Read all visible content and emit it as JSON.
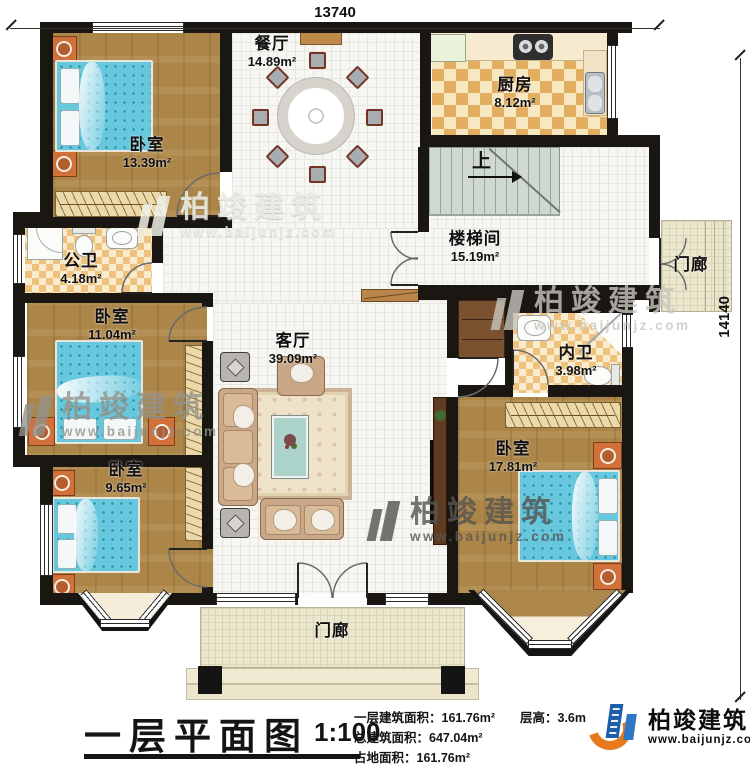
{
  "dimensions": {
    "top": "13740",
    "right": "14140"
  },
  "rooms": {
    "bedroom_tl": {
      "name": "卧室",
      "area": "13.39m²"
    },
    "dining": {
      "name": "餐厅",
      "area": "14.89m²"
    },
    "kitchen": {
      "name": "厨房",
      "area": "8.12m²"
    },
    "stairwell": {
      "name": "楼梯间",
      "area": "15.19m²"
    },
    "bath_public": {
      "name": "公卫",
      "area": "4.18m²"
    },
    "bedroom_ml": {
      "name": "卧室",
      "area": "11.04m²"
    },
    "living": {
      "name": "客厅",
      "area": "39.09m²"
    },
    "bath_private": {
      "name": "内卫",
      "area": "3.98m²"
    },
    "bedroom_br": {
      "name": "卧室",
      "area": "17.81m²"
    },
    "bedroom_bl": {
      "name": "卧室",
      "area": "9.65m²"
    },
    "porch_right": {
      "name": "门廊"
    },
    "porch_bottom": {
      "name": "门廊"
    }
  },
  "stairs": {
    "up_label": "上"
  },
  "title_block": {
    "title": "一层平面图",
    "scale": "1:100",
    "info_lines": [
      "一层建筑面积：161.76m²",
      "总建筑面积：647.04m²",
      "占地面积：161.76m²"
    ],
    "floor_height": "层高：3.6m"
  },
  "brand": {
    "name": "柏竣建筑",
    "url": "www.baijunjz.com"
  },
  "watermark": {
    "name": "柏竣建筑",
    "url": "www.baijunjz.com"
  },
  "colors": {
    "wall": "#1a1713",
    "wood_floor": "#ac8549",
    "bed": "#67c8dd",
    "kitchen_floor": "#e2af60",
    "stair": "#cfd9cf",
    "logo_blue": "#1c5fa8",
    "logo_orange": "#e87a1e"
  }
}
